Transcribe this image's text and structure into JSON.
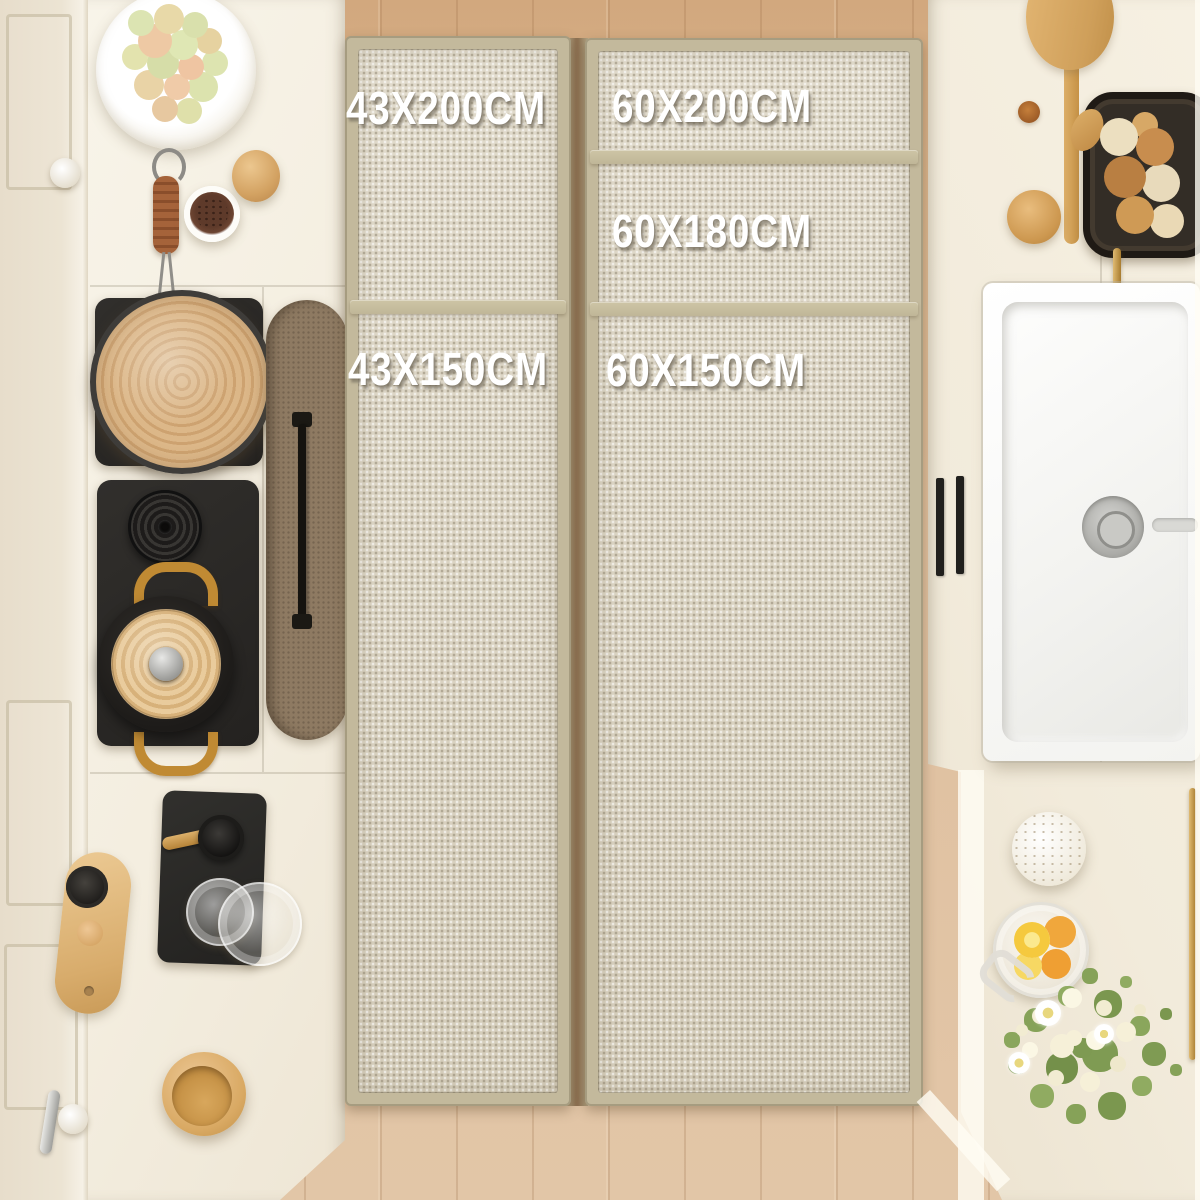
{
  "scene": {
    "description": "Top-down product photo of a kitchen: two beige woven runner rugs with tan borders lie on a light oak wood floor between cream cabinets; left side has a stove with pans, right side has a white farmhouse sink, bread basket and flowers. White size labels overlay the rugs.",
    "size_labels": [
      {
        "id": "left-top",
        "text": "43X200CM"
      },
      {
        "id": "right-top",
        "text": "60X200CM"
      },
      {
        "id": "right-middle",
        "text": "60X180CM"
      },
      {
        "id": "left-bottom",
        "text": "43X150CM"
      },
      {
        "id": "right-bottom",
        "text": "60X150CM"
      }
    ]
  },
  "palette": {
    "rug_fabric": "#ddd6c5",
    "rug_border": "#c3b99c",
    "floor_wood": "#dcb археo",
    "floor_wood_fix": "#dcb992",
    "cabinet_cream": "#f4eee1",
    "label_text": "#ffffff",
    "stove_mat": "#282624",
    "straw_lid": "#d5ad7c",
    "brass": "#c79035",
    "sink_white": "#fcfcfb"
  }
}
